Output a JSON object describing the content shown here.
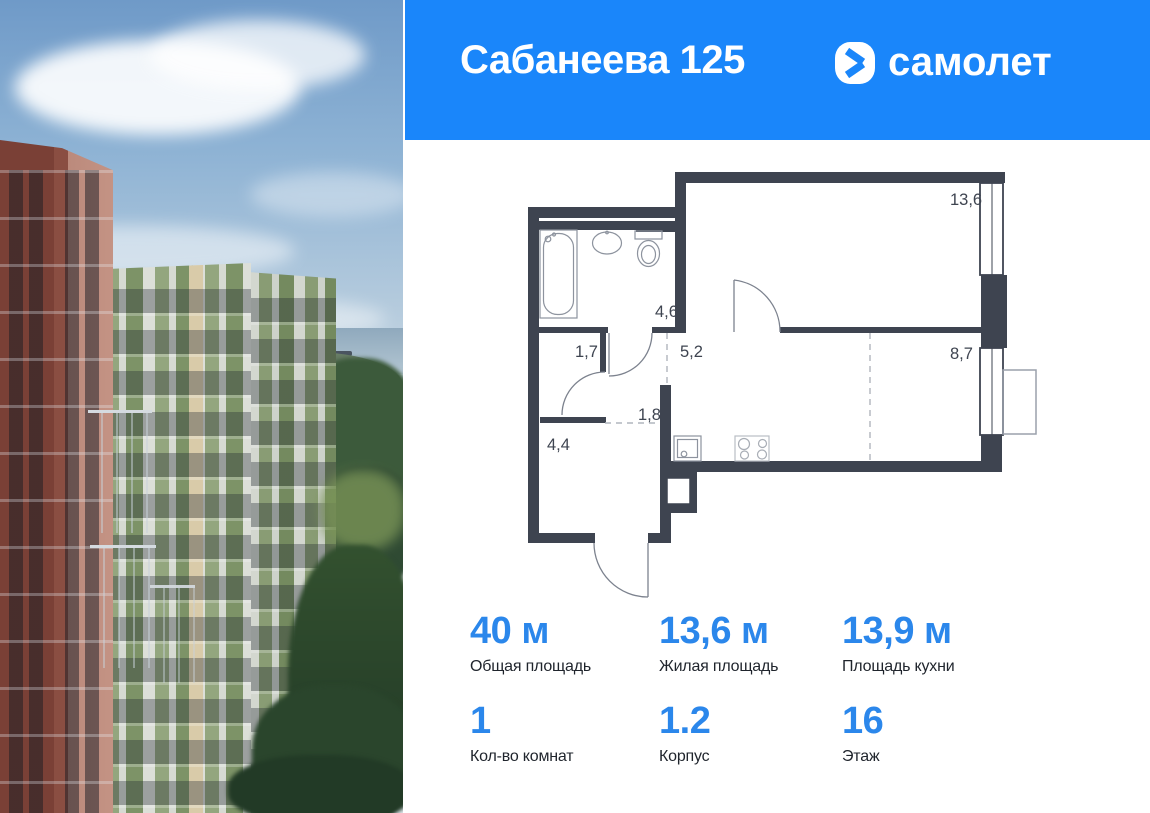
{
  "colors": {
    "brand_blue": "#1a86fa",
    "stat_number_blue": "#2b87eb",
    "plan_wall": "#3e4450"
  },
  "header": {
    "title": "Сабанеева 125",
    "logo_text": "самолет",
    "logo_icon": "samolet-chevron-icon"
  },
  "floor_plan": {
    "room_areas": {
      "living_room": "13,6",
      "bathroom": "4,6",
      "closet": "1,7",
      "hall": "5,2",
      "corridor": "1,8",
      "entry_room": "4,4",
      "bedroom": "8,7"
    }
  },
  "stats": {
    "items": [
      {
        "value": "40 м",
        "label": "Общая площадь"
      },
      {
        "value": "13,6 м",
        "label": "Жилая площадь"
      },
      {
        "value": "13,9 м",
        "label": "Площадь кухни"
      },
      {
        "value": "1",
        "label": "Кол-во комнат"
      },
      {
        "value": "1.2",
        "label": "Корпус"
      },
      {
        "value": "16",
        "label": "Этаж"
      }
    ]
  }
}
